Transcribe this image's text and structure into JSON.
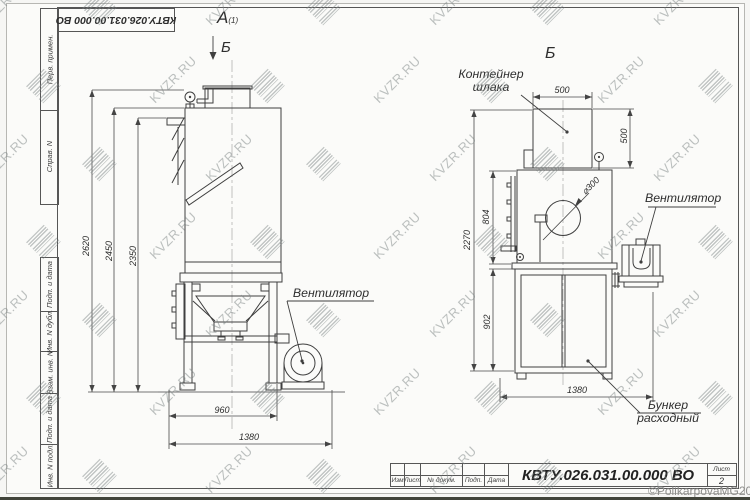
{
  "watermark": {
    "text": "KVZR.RU",
    "copyright": "©PolikarpovaMG2021"
  },
  "frame": {
    "left_labels": [
      "Перв. примен.",
      "Справ. N",
      "Подп. и дата",
      "Инв. N дубл.",
      "Взам. инв. N",
      "Подп. и дата",
      "Инв. N подл."
    ],
    "doc_number_top": "КВТУ.026.031.00.000  ВО"
  },
  "title_block": {
    "columns": [
      "Изм",
      "Лист",
      "№ докум.",
      "Подп.",
      "Дата"
    ],
    "doc_number": "КВТУ.026.031.00.000  ВО",
    "sheet_label": "Лист",
    "sheet_number": "2"
  },
  "views": {
    "left": {
      "label": "А",
      "label_note": "(1)",
      "section_arrow_label": "Б",
      "dims": {
        "height_overall": "2620",
        "height_body": "2450",
        "height_inlet": "2350",
        "width_frame": "960",
        "width_overall": "1380"
      },
      "callouts": {
        "fan": "Вентилятор"
      }
    },
    "right": {
      "label": "Б",
      "dims": {
        "container_width": "500",
        "container_height": "500",
        "body_height": "804",
        "height_total": "2270",
        "bunker_height": "902",
        "width_overall": "1380",
        "opening_diameter": "⌀300"
      },
      "callouts": {
        "slag_container": [
          "Контейнер",
          "шлака"
        ],
        "fan": "Вентилятор",
        "feed_bunker": [
          "Бункер",
          "расходный"
        ]
      }
    }
  }
}
